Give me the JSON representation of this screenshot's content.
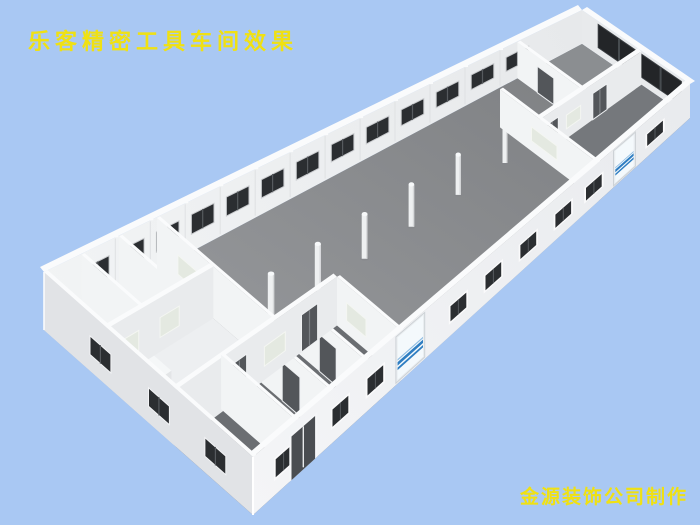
{
  "meta": {
    "width": 700,
    "height": 525,
    "background_color": "#a9c8f3"
  },
  "overlay": {
    "title": "乐客精密工具车间效果",
    "credit": "金源装饰公司制作",
    "text_color": "#f0e112"
  },
  "scene": {
    "corners": {
      "farA": [
        44,
        330
      ],
      "farB": [
        582,
        44
      ],
      "nearA": [
        253,
        515
      ],
      "nearB": [
        690,
        118
      ]
    },
    "wall_height": {
      "near": 58,
      "far": 34
    },
    "colors": {
      "floor_near": "#9a9c9f",
      "floor_far": "#7e8083",
      "nw_wall_near": "#f2f4f5",
      "nw_wall_far": "#e7e9eb",
      "ne_wall": "#e8eaec",
      "se_wall_near": "#f4f5f7",
      "se_wall_far": "#e9ebee",
      "sw_wall": "#e1e3e6",
      "cap": "#fafbfc",
      "cross_wall": "#f2f4f5",
      "long_wall": "#e9ebed",
      "wall_seam": "#dfe1e3",
      "window_dark": "#2b2e31",
      "window_divider": "#565a5e",
      "window_frame": "#c9cbce",
      "band_dark": "#232528",
      "band_divider": "#474c50",
      "door_dark": "#53565a",
      "door_divider": "#7c8084",
      "door_frame": "#eef0f2",
      "interior_window": "#e4e9e1",
      "interior_window_frame": "#f4f6f2",
      "glass_frame": "#e9edf0",
      "glass_bg": "#f4f9fc",
      "glass_stripe_dark": "#2f7ec2",
      "glass_stripe_light": "#8cbbe2",
      "west_floor": "#edeff1",
      "vestibule_floor": "#f8fafb",
      "south_floor": "#6b6e72",
      "east_floor": "#75787c",
      "band_room_floor": "#8b8e91",
      "column_fill": "#eef0f1",
      "column_top": "#f7f9fa",
      "column_shade": "#d7d9db",
      "column_shadow": "#83868a",
      "fixture_top": "#f5f7f8",
      "fixture_front": "#e3e5e7",
      "dark_panel": "#3b3e41"
    },
    "nw_windows": {
      "centers": [
        0.1,
        0.165,
        0.23,
        0.295,
        0.36,
        0.425,
        0.49,
        0.555,
        0.62,
        0.685,
        0.75,
        0.815,
        0.88
      ],
      "half_width": 0.021,
      "y0": 0.34,
      "y1": 0.72
    },
    "ne_band": {
      "v0": 0.15,
      "v1": 0.92,
      "y0": 0.22,
      "y1": 0.9,
      "panes": 4
    },
    "se_windows": {
      "centers": [
        0.07,
        0.2,
        0.28,
        0.47,
        0.55,
        0.63,
        0.71,
        0.78,
        0.92
      ],
      "half_width": 0.018,
      "y0": 0.3,
      "y1": 0.62
    },
    "se_door": {
      "u": 0.115,
      "half_width": 0.027,
      "y1": 0.78
    },
    "se_glass": [
      {
        "u": 0.36,
        "half_width": 0.029
      },
      {
        "u": 0.85,
        "half_width": 0.021
      }
    ],
    "sw_windows": {
      "centers": [
        0.27,
        0.55,
        0.82
      ],
      "half_width": 0.05,
      "y0": 0.28,
      "y1": 0.6
    },
    "floors": [
      {
        "u0": 0,
        "v0": 0,
        "u1": 0.21,
        "v1": 0.62,
        "color_key": "west_floor",
        "name": "west-rooms-floor"
      },
      {
        "u0": 0.13,
        "v0": 0.48,
        "u1": 0.22,
        "v1": 0.64,
        "color_key": "vestibule_floor",
        "name": "vestibule-floor"
      },
      {
        "u0": 0,
        "v0": 0.63,
        "u1": 0.34,
        "v1": 1,
        "color_key": "south_floor",
        "name": "south-rooms-floor"
      },
      {
        "u0": 0.79,
        "v0": 0.55,
        "u1": 1,
        "v1": 1,
        "color_key": "east_floor",
        "name": "east-room-floor"
      },
      {
        "u0": 0.88,
        "v0": 0,
        "u1": 1,
        "v1": 0.55,
        "color_key": "band_room_floor",
        "name": "band-room-floor"
      }
    ],
    "interior_walls": [
      {
        "a": [
          0.07,
          0
        ],
        "b": [
          0.07,
          0.3
        ],
        "features": []
      },
      {
        "a": [
          0.14,
          0
        ],
        "b": [
          0.14,
          0.3
        ],
        "features": []
      },
      {
        "a": [
          0,
          0.3
        ],
        "b": [
          0.21,
          0.3
        ],
        "features": [
          {
            "type": "window",
            "t0": 0.12,
            "t1": 0.3
          },
          {
            "type": "window",
            "t0": 0.5,
            "t1": 0.68
          }
        ]
      },
      {
        "a": [
          0.21,
          0
        ],
        "b": [
          0.21,
          0.62
        ],
        "features": [
          {
            "type": "window",
            "t0": 0.18,
            "t1": 0.38
          }
        ]
      },
      {
        "a": [
          0.1,
          0.62
        ],
        "b": [
          0.1,
          1
        ],
        "features": []
      },
      {
        "a": [
          0,
          0.63
        ],
        "b": [
          0.34,
          0.63
        ],
        "features": [
          {
            "type": "door",
            "t0": 0.35,
            "t1": 0.44,
            "double": true
          },
          {
            "type": "window",
            "t0": 0.55,
            "t1": 0.68
          },
          {
            "type": "door",
            "t0": 0.78,
            "t1": 0.88,
            "double": true
          }
        ]
      },
      {
        "a": [
          0.18,
          0.63
        ],
        "b": [
          0.18,
          1
        ],
        "features": [
          {
            "type": "door",
            "t0": 0.3,
            "t1": 0.55
          }
        ]
      },
      {
        "a": [
          0.26,
          0.63
        ],
        "b": [
          0.26,
          1
        ],
        "features": [
          {
            "type": "door",
            "t0": 0.3,
            "t1": 0.55
          }
        ]
      },
      {
        "a": [
          0.34,
          0.63
        ],
        "b": [
          0.34,
          1
        ],
        "features": [
          {
            "type": "window",
            "t0": 0.15,
            "t1": 0.45
          }
        ]
      },
      {
        "a": [
          0.79,
          0.24
        ],
        "b": [
          0.79,
          1
        ],
        "features": [
          {
            "type": "window",
            "t0": 0.32,
            "t1": 0.58
          }
        ]
      },
      {
        "a": [
          0.79,
          0.55
        ],
        "b": [
          1,
          0.55
        ],
        "features": [
          {
            "type": "door",
            "t0": 0.06,
            "t1": 0.18,
            "double": true
          },
          {
            "type": "window",
            "t0": 0.26,
            "t1": 0.4
          },
          {
            "type": "door",
            "t0": 0.52,
            "t1": 0.66,
            "double": true
          }
        ]
      },
      {
        "a": [
          0.88,
          0
        ],
        "b": [
          0.88,
          0.55
        ],
        "features": [
          {
            "type": "door",
            "t0": 0.3,
            "t1": 0.55
          }
        ]
      }
    ],
    "columns": {
      "v": 0.45,
      "u_list": [
        0.27,
        0.365,
        0.46,
        0.555,
        0.65,
        0.745
      ]
    },
    "fixtures": [
      {
        "u0": 0.03,
        "v0": 0.33,
        "u1": 0.08,
        "v1": 0.42,
        "h": 0.18
      },
      {
        "u0": 0.03,
        "v0": 0.44,
        "u1": 0.06,
        "v1": 0.5,
        "h": 0.12
      }
    ],
    "dark_panels": [
      {
        "a": [
          0.04,
          0.16
        ],
        "b": [
          0.04,
          0.3
        ],
        "h": 0.45
      }
    ]
  }
}
